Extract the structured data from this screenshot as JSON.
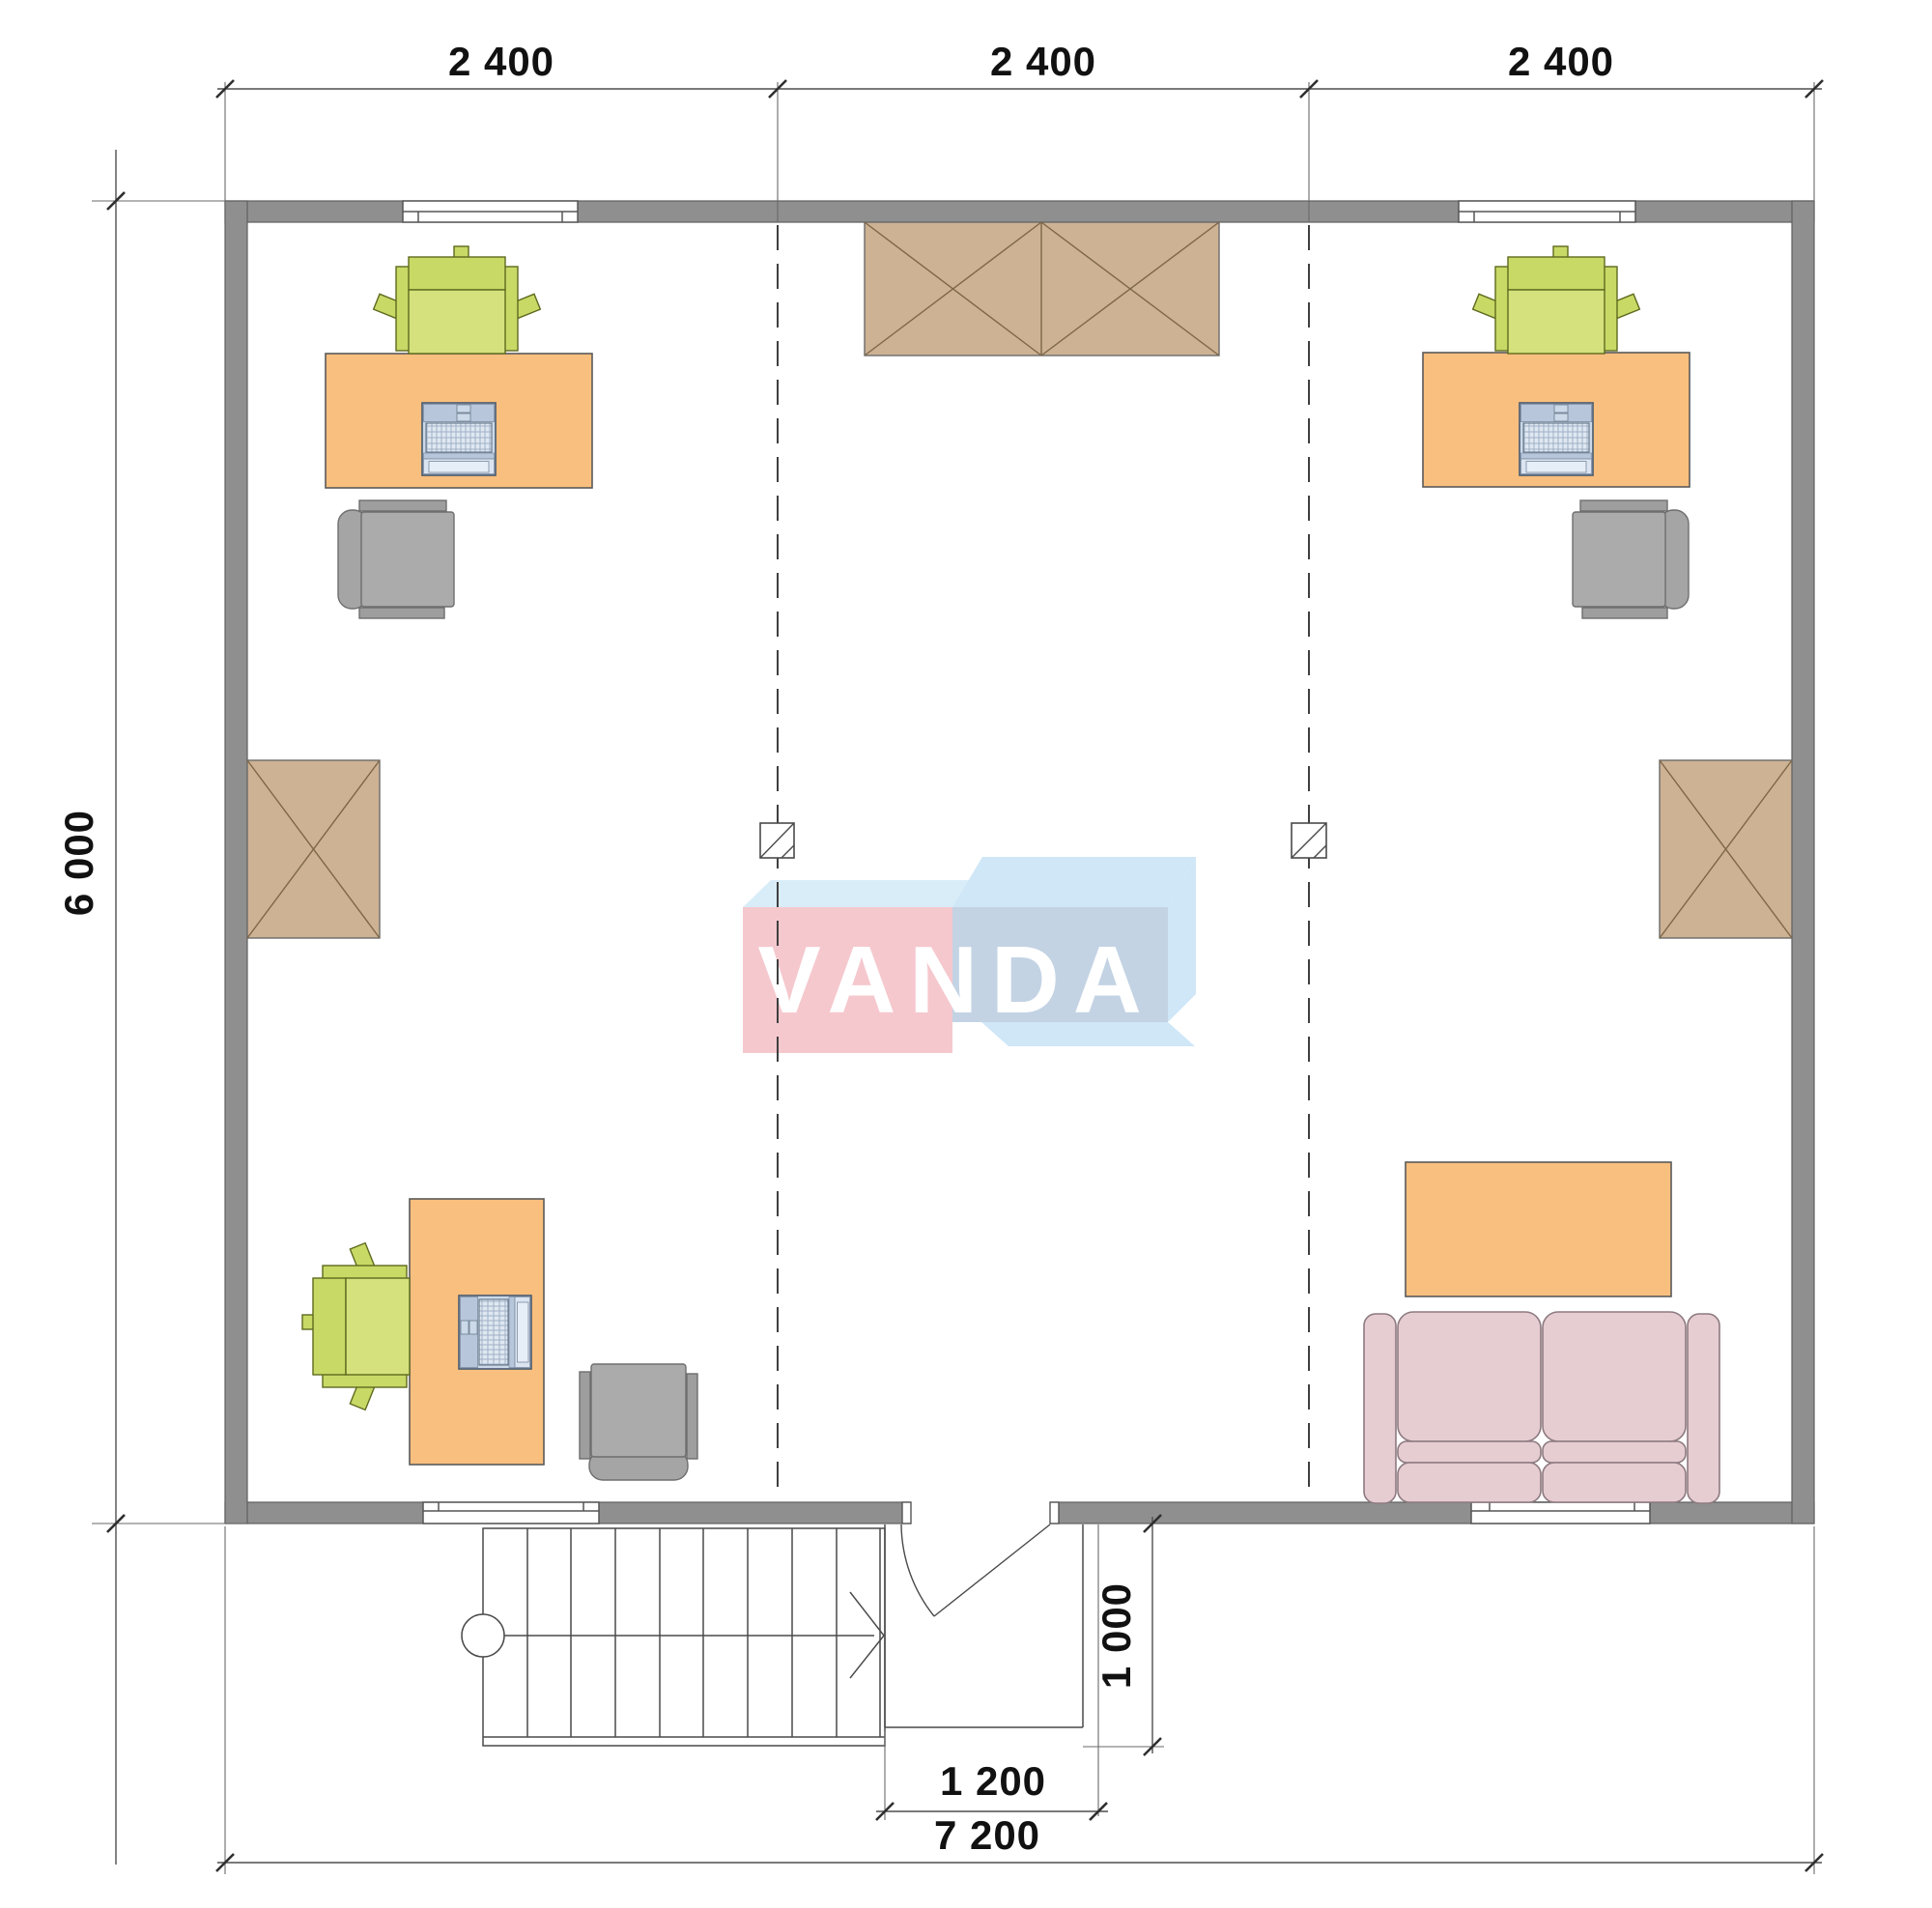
{
  "watermark": {
    "text": "VANDA"
  },
  "dimensions": {
    "top": [
      "2 400",
      "2 400",
      "2 400"
    ],
    "left_total": "6 000",
    "bottom_total": "7 200",
    "entry_width": "1 200",
    "entry_depth": "1 000"
  },
  "colors": {
    "wall": "#8f8f8f",
    "desk": "#f9bf7e",
    "task_chair": "#c9d966",
    "office_chair": "#ababab",
    "cabinet": "#cdb293",
    "cabinet_line": "#7d6748",
    "sofa": "#e6cdd2",
    "logo_pink": "#f5c8ce",
    "logo_blue_light": "#cfe7f7",
    "logo_blue_front": "#c3d3e4"
  }
}
